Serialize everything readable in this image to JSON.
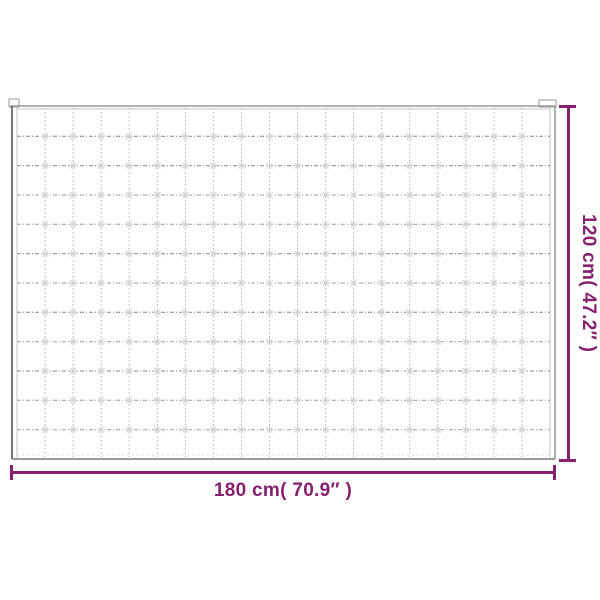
{
  "diagram": {
    "accent_color": "#85216d",
    "width_label": "180 cm( 70.9″ )",
    "height_label": "120 cm( 47.2″ )",
    "blanket": {
      "columns": 19,
      "rows": 12,
      "dark_rows": [
        1,
        2,
        5,
        7,
        9
      ],
      "edge_color": "#9a9a9a",
      "dark_edge_color": "#6a6a6a",
      "inner_edge_color": "#c4c4c4",
      "grid_color": "#b4b4b4",
      "row_line_color": "#9e9e9e",
      "dark_row_color": "#868686",
      "tuft_color": "#d2d2d2"
    }
  }
}
